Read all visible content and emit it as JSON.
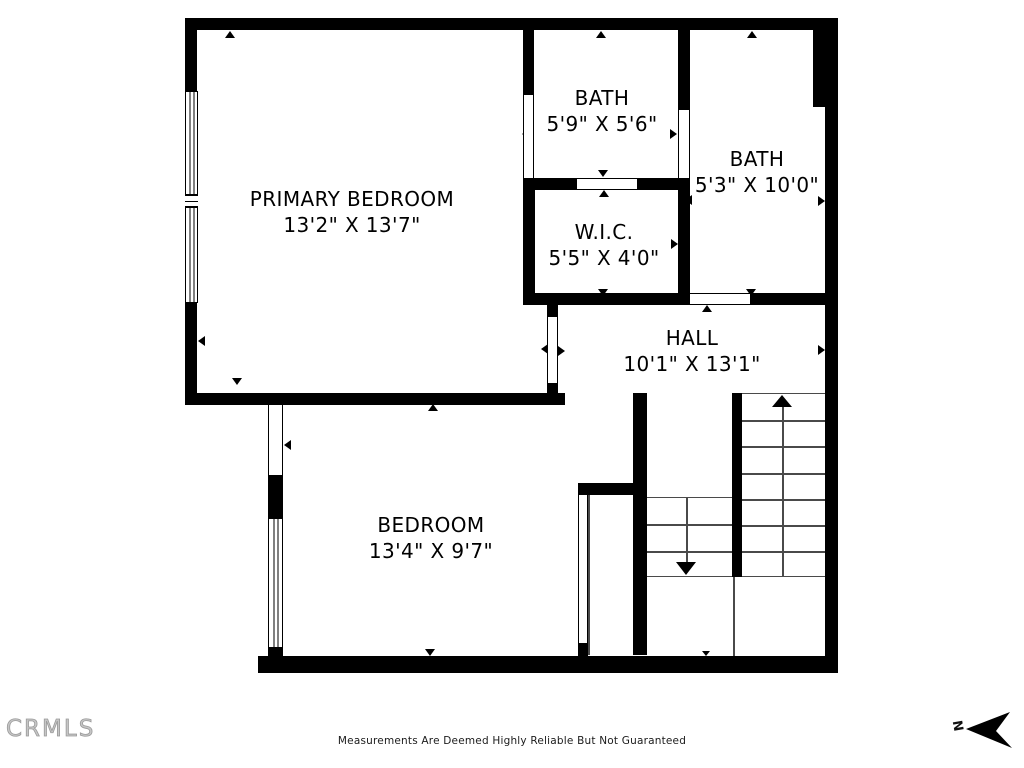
{
  "plan": {
    "rooms": [
      {
        "id": "primary-bedroom",
        "name": "PRIMARY BEDROOM",
        "dims": "13'2\" X 13'7\""
      },
      {
        "id": "bath-top",
        "name": "BATH",
        "dims": "5'9\" X 5'6\""
      },
      {
        "id": "bath-right",
        "name": "BATH",
        "dims": "5'3\" X 10'0\""
      },
      {
        "id": "wic",
        "name": "W.I.C.",
        "dims": "5'5\" X 4'0\""
      },
      {
        "id": "hall",
        "name": "HALL",
        "dims": "10'1\" X 13'1\""
      },
      {
        "id": "bedroom",
        "name": "BEDROOM",
        "dims": "13'4\" X 9'7\""
      }
    ],
    "stairs": {
      "up_flight_treads": 7,
      "down_flight_treads": 3
    }
  },
  "footer": {
    "watermark": "CRMLS",
    "disclaimer": "Measurements Are Deemed Highly Reliable But Not Guaranteed",
    "north_label": "N"
  },
  "colors": {
    "wall": "#000000",
    "stair_line": "#4a4a4a",
    "watermark": "#c4c4c4",
    "text": "#000000"
  }
}
